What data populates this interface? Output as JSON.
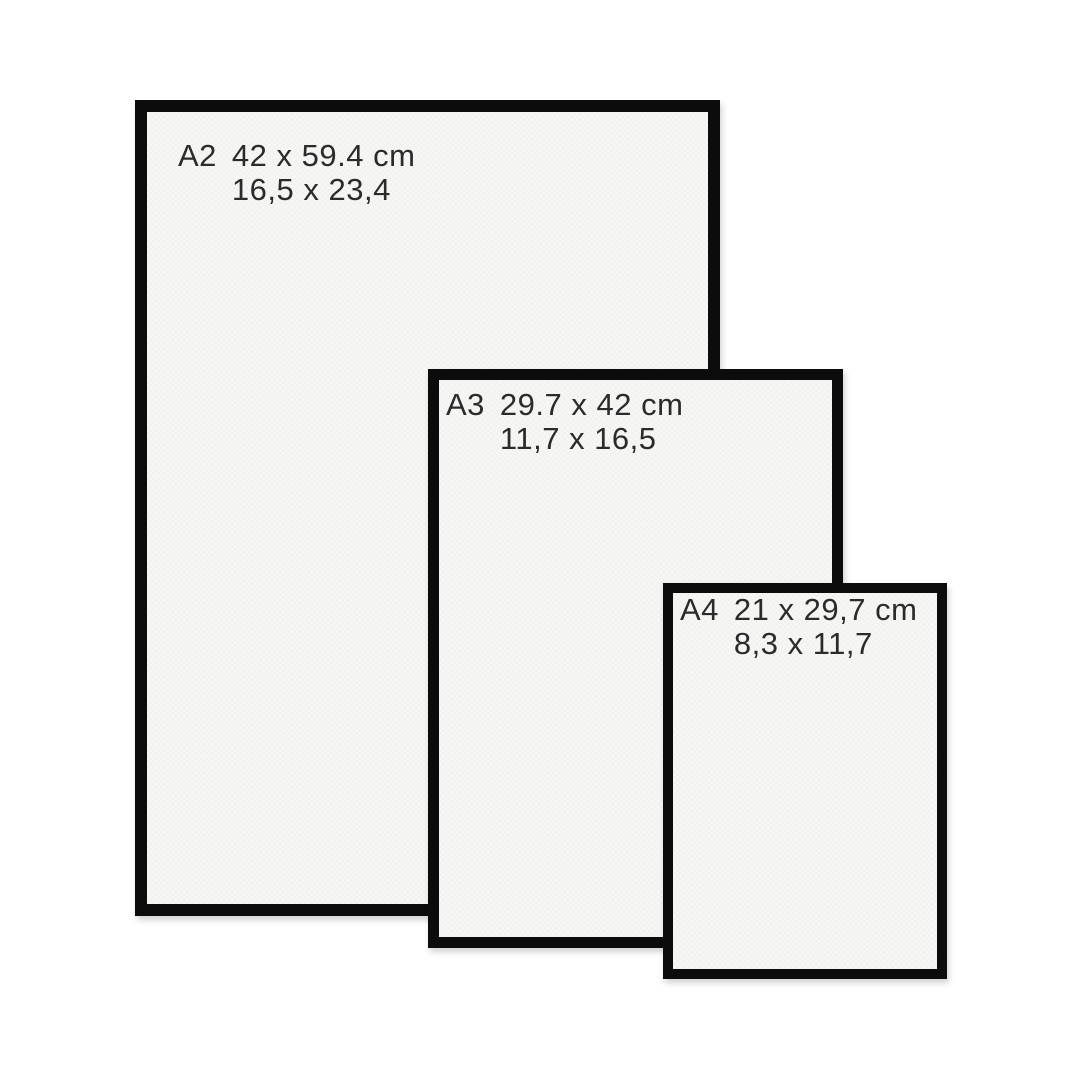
{
  "diagram_title": "Paper / frame size comparison",
  "colors": {
    "background": "#ffffff",
    "frame": "#0c0c0c",
    "paper": "#f7f7f5",
    "text": "#2b2b2b"
  },
  "sizes": [
    {
      "code": "A2",
      "cm": "42 x 59.4 cm",
      "inches": "16,5 x 23,4"
    },
    {
      "code": "A3",
      "cm": "29.7 x 42 cm",
      "inches": "11,7 x 16,5"
    },
    {
      "code": "A4",
      "cm": "21 x 29,7 cm",
      "inches": "8,3 x 11,7"
    }
  ]
}
